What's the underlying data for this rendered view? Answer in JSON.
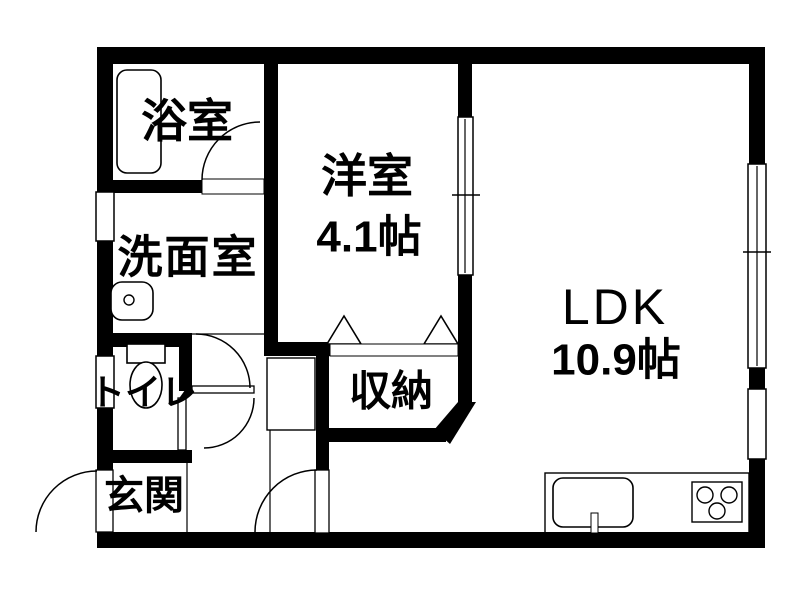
{
  "plan": {
    "type": "apartment-floor-plan",
    "background_color": "#ffffff",
    "wall_color": "#000000",
    "rooms": {
      "bathroom": {
        "label": "浴室"
      },
      "washroom": {
        "label": "洗面室"
      },
      "toilet": {
        "label": "トイレ"
      },
      "entrance": {
        "label": "玄関"
      },
      "western_room": {
        "label": "洋室",
        "size": "4.1帖"
      },
      "storage": {
        "label": "収納"
      },
      "ldk": {
        "label": "LDK",
        "size": "10.9帖"
      }
    },
    "fixtures": [
      "bathtub",
      "washbasin",
      "toilet-bowl",
      "kitchen-sink",
      "stove-3-burner"
    ],
    "openings": [
      "entrance-door",
      "hall-door",
      "toilet-door",
      "washroom-door",
      "bathroom-door",
      "sliding-door-western-ldk",
      "window-washroom",
      "window-toilet",
      "window-ldk-east",
      "window-kitchen-east",
      "storage-bifold-doors"
    ]
  }
}
